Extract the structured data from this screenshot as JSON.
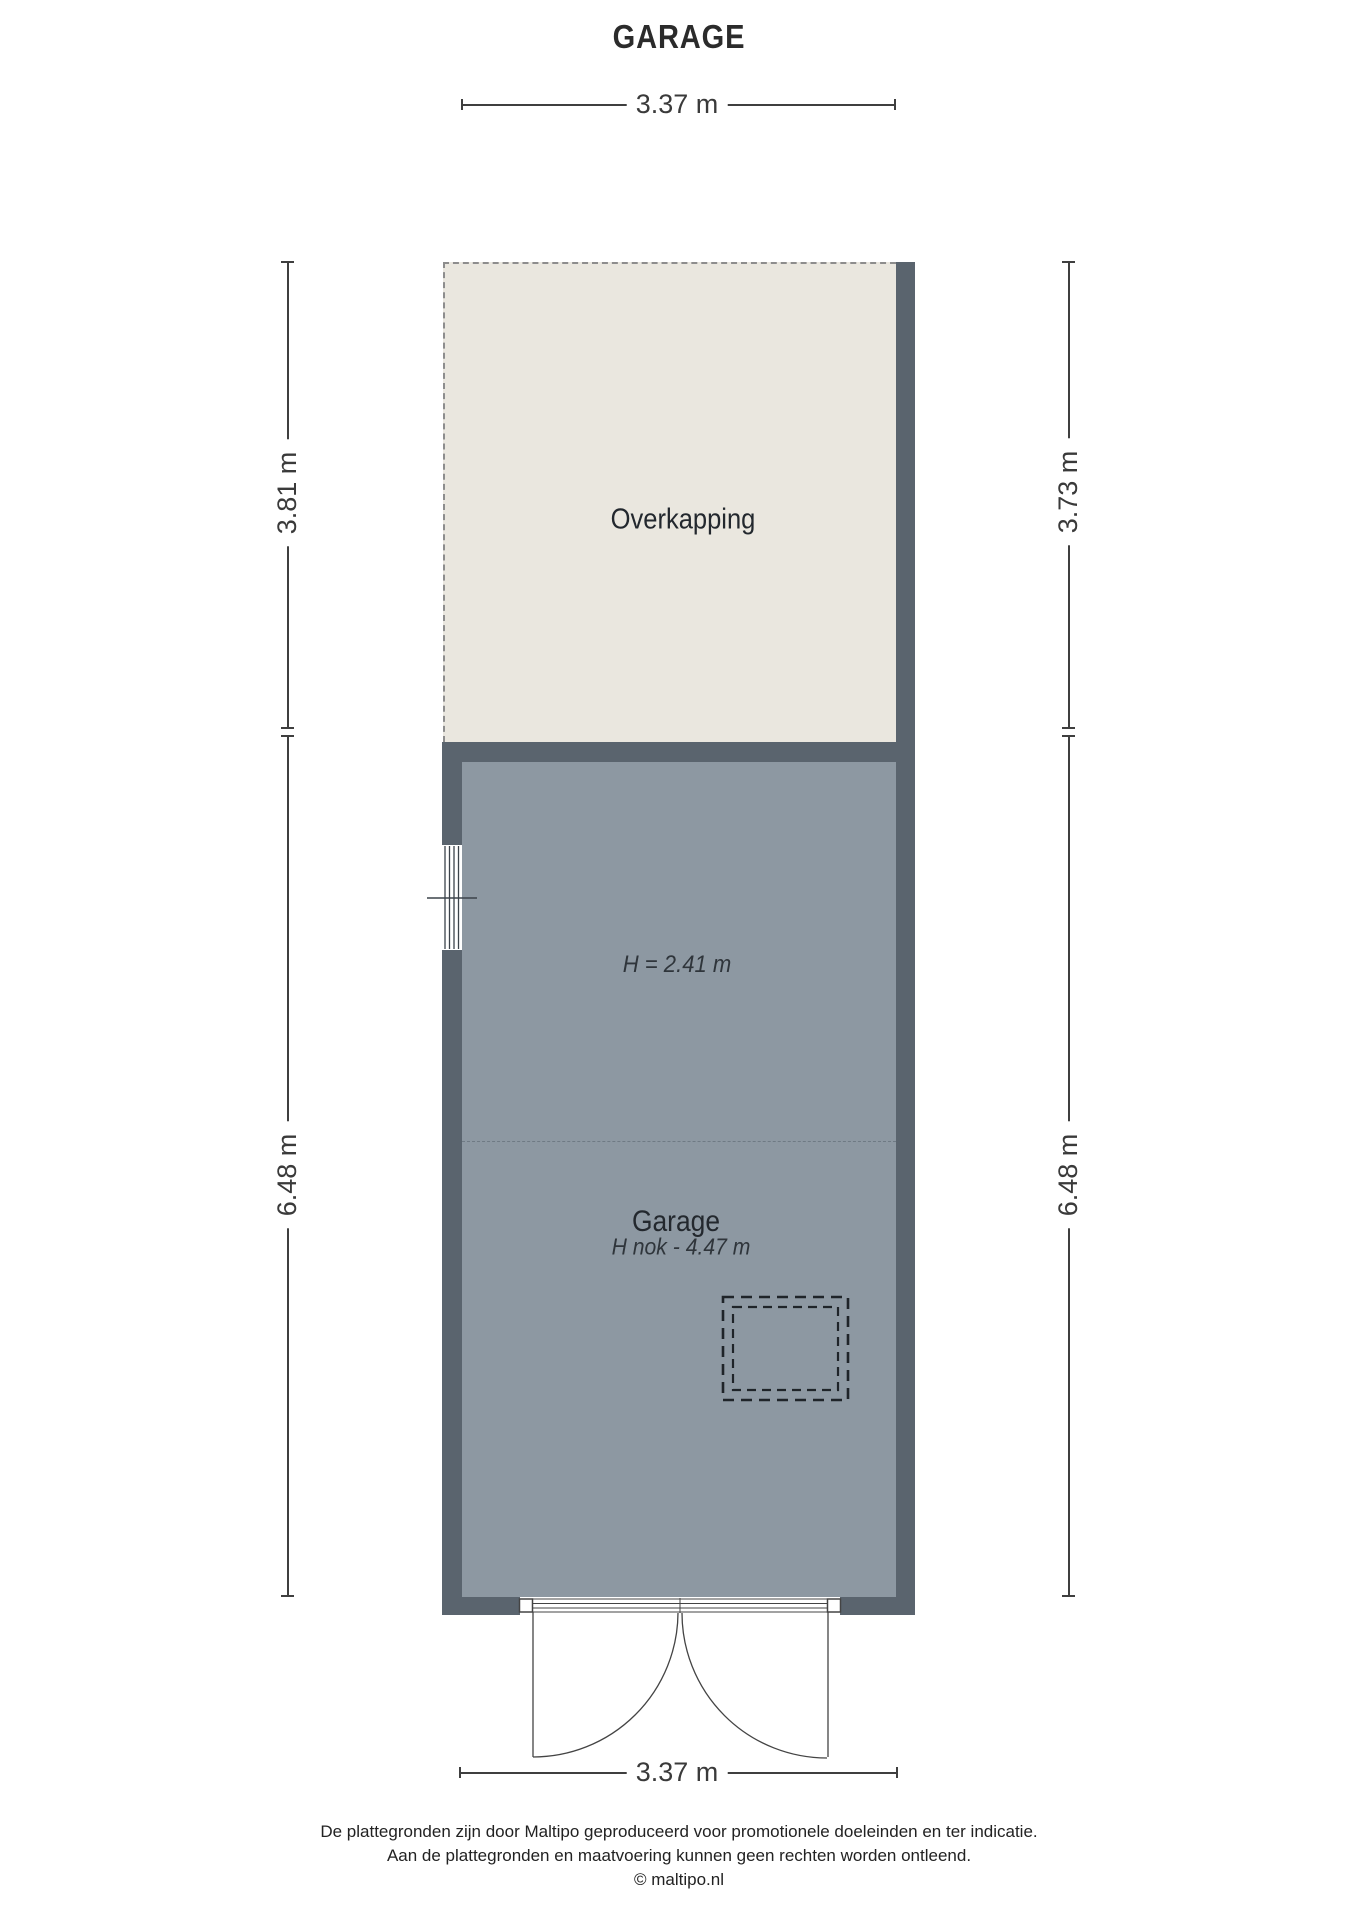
{
  "title": "GARAGE",
  "rooms": {
    "overkapping": {
      "label": "Overkapping"
    },
    "garage": {
      "label": "Garage",
      "height_label": "H = 2.41 m",
      "ridge_label": "H nok - 4.47 m"
    }
  },
  "dimensions": {
    "top": "3.37 m",
    "bottom": "3.37 m",
    "left_upper": "3.81 m",
    "left_lower": "6.48 m",
    "right_upper": "3.73 m",
    "right_lower": "6.48 m"
  },
  "footer": {
    "line1": "De plattegronden zijn door Maltipo geproduceerd voor promotionele doeleinden en ter indicatie.",
    "line2": "Aan de plattegronden en maatvoering kunnen geen rechten worden ontleend.",
    "line3": "© maltipo.nl"
  },
  "colors": {
    "wall": "#5a646e",
    "garage_floor": "#8d98a2",
    "canopy_fill": "#eae7df",
    "dashed_border": "#8d8d8d",
    "line": "#3f3f3f",
    "background": "#ffffff"
  }
}
